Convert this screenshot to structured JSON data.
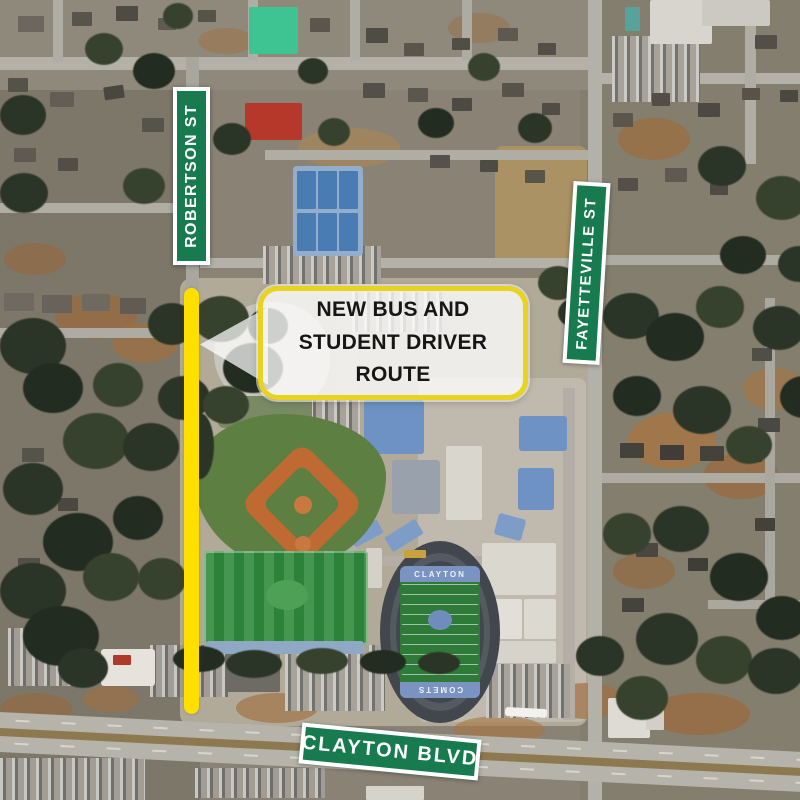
{
  "callout": {
    "line1": "NEW BUS AND",
    "line2": "STUDENT DRIVER ROUTE"
  },
  "signs": {
    "robertson": "ROBERTSON ST",
    "fayetteville": "FAYETTEVILLE ST",
    "clayton_blvd": "CLAYTON BLVD"
  },
  "stadium": {
    "home_endzone": "CLAYTON",
    "away_endzone": "COMETS"
  },
  "colors": {
    "sign_green": "#187a4f",
    "sign_text": "#ffffff",
    "route_yellow": "#ffdf00",
    "callout_border": "#e8d31f",
    "callout_text": "#161616",
    "endzone_blue": "#7b93c2",
    "turf_green": "#2f8a3c",
    "track_gray": "#42464d"
  }
}
